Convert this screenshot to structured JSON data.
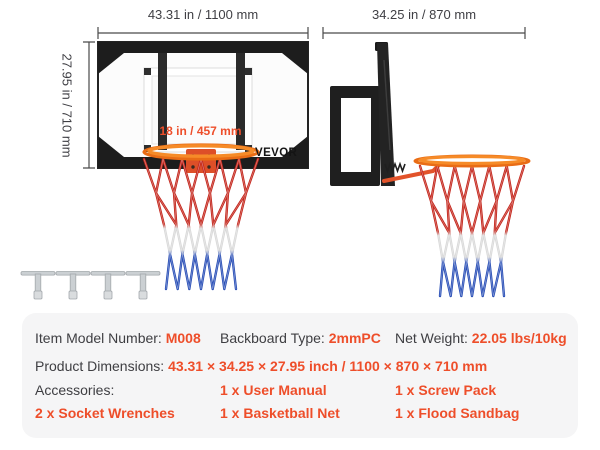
{
  "illustration": {
    "front_view": {
      "width_label": "43.31 in / 1100 mm",
      "height_label": "27.95 in / 710 mm",
      "rim_diameter_label": "18 in / 457 mm",
      "brand_logo": "VEVOR"
    },
    "side_view": {
      "depth_label": "34.25 in / 870 mm"
    }
  },
  "colors": {
    "accent_red": "#ee4e2a",
    "dimension_text_dark": "#3f3f44",
    "rim_orange": "#ef7d1e",
    "net_red": "#c4261c",
    "net_white": "#d9d9d9",
    "net_blue": "#2b50b7",
    "frame_black": "#1d1d1d",
    "panel_background": "#f5f5f6"
  },
  "spec_panel": {
    "row1": [
      {
        "label": "Item Model Number: ",
        "value": "M008"
      },
      {
        "label": "Backboard Type: ",
        "value": "2mmPC"
      },
      {
        "label": "Net Weight: ",
        "value": "22.05 lbs/10kg"
      }
    ],
    "row2": {
      "label": "Product Dimensions: ",
      "value": "43.31 × 34.25 × 27.95 inch / 1100 × 870 × 710 mm"
    },
    "row3": [
      {
        "label": "Accessories:",
        "value": ""
      },
      {
        "label": "",
        "value": "1 x User Manual"
      },
      {
        "label": "",
        "value": "1 x Screw Pack"
      }
    ],
    "row4": [
      {
        "label": "",
        "value": "2 x Socket Wrenches"
      },
      {
        "label": "",
        "value": "1 x Basketball Net"
      },
      {
        "label": "",
        "value": "1 x Flood Sandbag"
      }
    ]
  }
}
